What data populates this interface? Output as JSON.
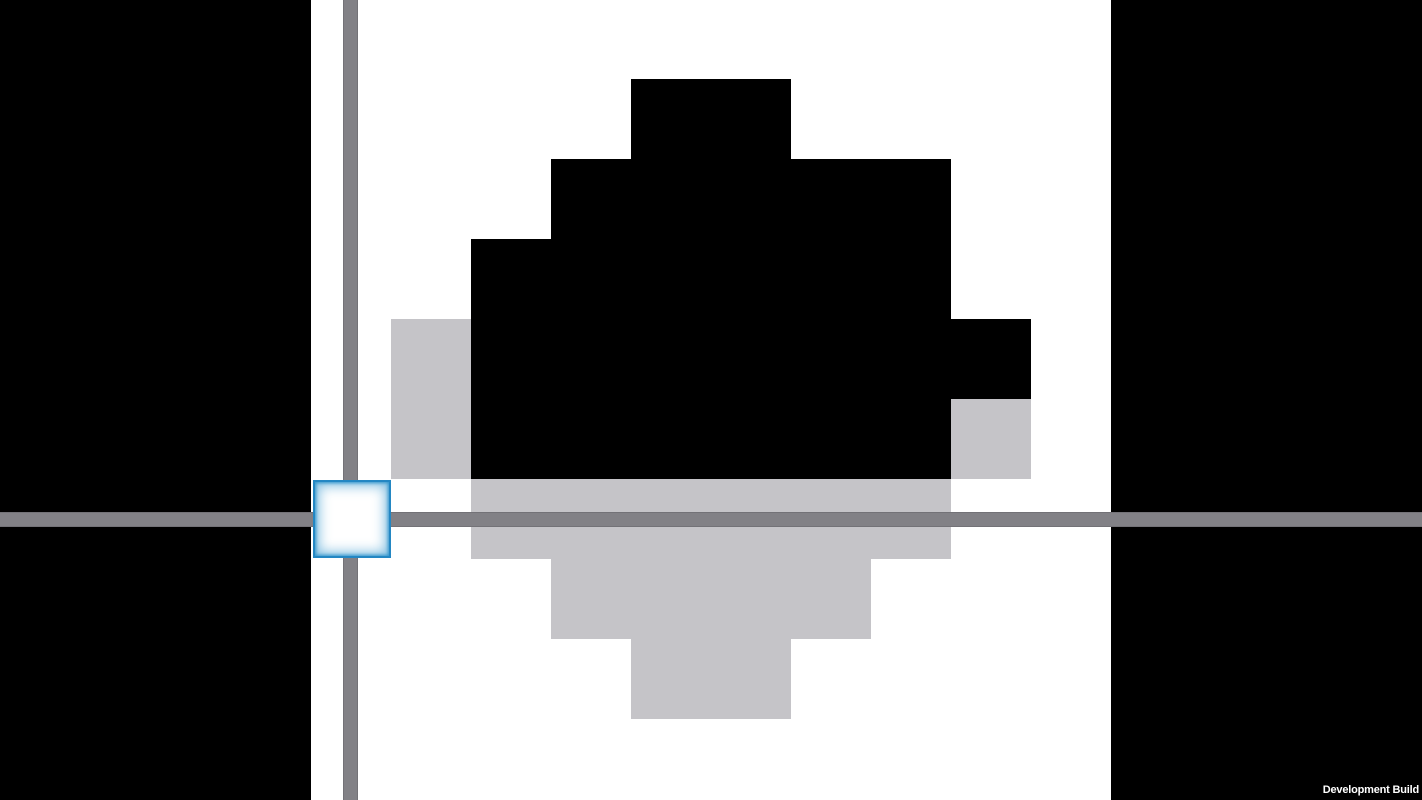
{
  "watermark": {
    "label": "Development Build"
  },
  "colors": {
    "side_panel_black": "#000000",
    "playfield_white": "#ffffff",
    "block_black": "#000000",
    "ghost_block_gray": "#c5c4c8",
    "axis_gray": "#828186",
    "cursor_border_blue": "#2387c3",
    "cursor_glow_blue": "#2f94cc"
  },
  "board": {
    "grid": {
      "tile_size": 80,
      "left_base": 311,
      "top_base": 479
    },
    "black_cells": [
      [
        4,
        5
      ],
      [
        5,
        5
      ],
      [
        3,
        4
      ],
      [
        4,
        4
      ],
      [
        5,
        4
      ],
      [
        6,
        4
      ],
      [
        7,
        4
      ],
      [
        2,
        3
      ],
      [
        3,
        3
      ],
      [
        4,
        3
      ],
      [
        5,
        3
      ],
      [
        6,
        3
      ],
      [
        7,
        3
      ],
      [
        2,
        2
      ],
      [
        3,
        2
      ],
      [
        4,
        2
      ],
      [
        5,
        2
      ],
      [
        6,
        2
      ],
      [
        7,
        2
      ],
      [
        8,
        2
      ],
      [
        2,
        1
      ],
      [
        3,
        1
      ],
      [
        4,
        1
      ],
      [
        5,
        1
      ],
      [
        6,
        1
      ],
      [
        7,
        1
      ]
    ],
    "gray_cells_above_axis": [
      [
        1,
        2
      ],
      [
        1,
        1
      ],
      [
        8,
        1
      ]
    ],
    "gray_cells_below_axis": [
      [
        2,
        0
      ],
      [
        3,
        0
      ],
      [
        4,
        0
      ],
      [
        5,
        0
      ],
      [
        6,
        0
      ],
      [
        7,
        0
      ],
      [
        3,
        -1
      ],
      [
        4,
        -1
      ],
      [
        5,
        -1
      ],
      [
        6,
        -1
      ],
      [
        4,
        -2
      ],
      [
        5,
        -2
      ]
    ]
  },
  "cursor": {
    "x": 313,
    "y": 480,
    "width": 78,
    "height": 78
  },
  "axes": {
    "horizontal": {
      "y": 512,
      "height": 15
    },
    "vertical": {
      "x": 343,
      "width": 15
    }
  },
  "panels": {
    "left": {
      "x": 0,
      "width": 311
    },
    "right": {
      "x": 1111,
      "width": 311
    }
  }
}
